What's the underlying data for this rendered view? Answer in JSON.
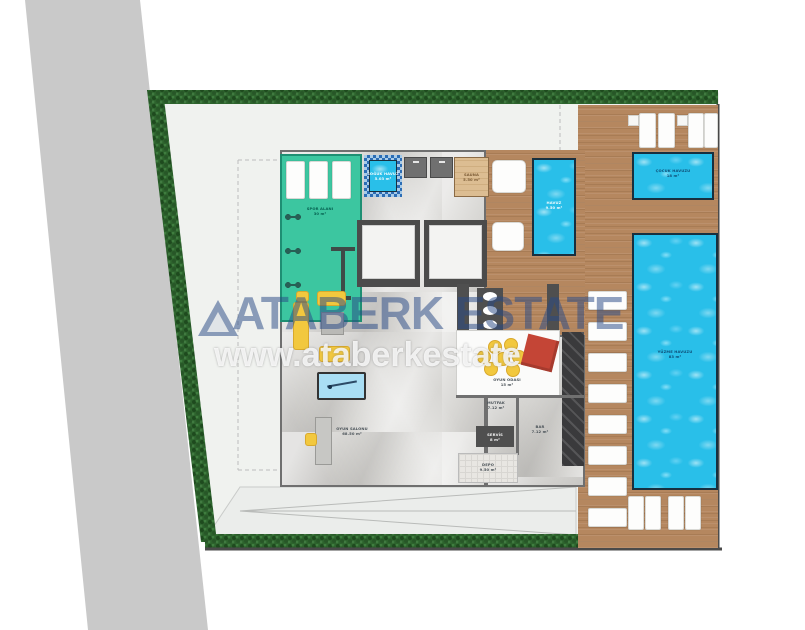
{
  "watermark": {
    "brand": "ATABERK ESTATE",
    "url": "www.ataberkestate"
  },
  "site": {
    "rooms": {
      "gym": {
        "label": "SPOR ALANI",
        "area": "30 m²"
      },
      "cold_pool": {
        "label": "SOĞUK HAVUZ",
        "area": "5.03 m²"
      },
      "sauna": {
        "label": "SAUNA",
        "area": "5.50 m²"
      },
      "game_room": {
        "label": "OYUN SALONU",
        "area": "68.50 m²"
      },
      "lounge": {
        "label": "OYUN ODASI",
        "area": "15 m²"
      },
      "kitchen": {
        "label": "MUTFAK",
        "area": "7.12 m²"
      },
      "service": {
        "label": "SERVİS",
        "area": "8 m²"
      },
      "storage": {
        "label": "DEPO",
        "area": "9.50 m²"
      },
      "bar": {
        "label": "BAR",
        "area": "7.12 m²"
      }
    },
    "pools": {
      "kids": {
        "label": "ÇOCUK HAVUZU",
        "area": "18 m²"
      },
      "main": {
        "label": "YÜZME HAVUZU",
        "area": "83 m²"
      },
      "plunge": {
        "label": "HAVUZ",
        "area": "9.50 m²"
      }
    }
  },
  "colors": {
    "water": "#29bfe9",
    "gym_teal": "#3cc6a0",
    "deck_wood": "#b5875f",
    "hedge_green": "#2d632d",
    "road_gray": "#c9c9c9",
    "marble": "#d8d7d4",
    "accent_yellow": "#f2c83e",
    "accent_red": "#c44536",
    "watermark_blue": "#2b4a86"
  }
}
